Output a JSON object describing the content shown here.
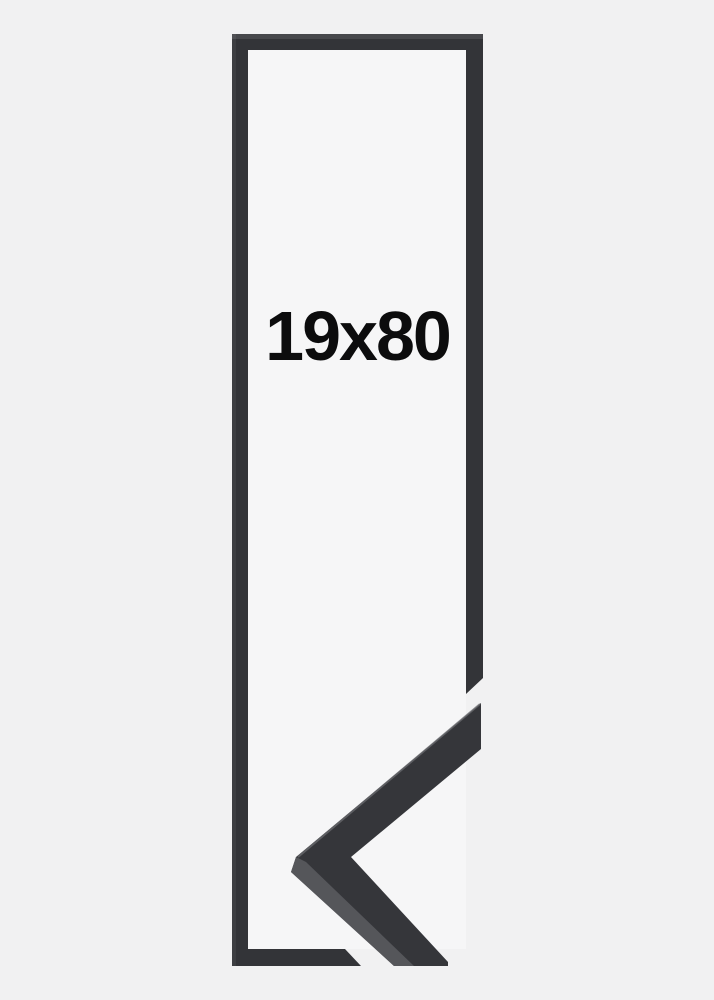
{
  "product": {
    "size_label": "19x80"
  },
  "image": {
    "description": "black picture frame, portrait orientation, with mitered corner profile sample overlapping bottom right"
  },
  "colors": {
    "background": "#f1f1f2",
    "frame_interior": "#f6f6f7",
    "frame_dark": "#333438",
    "sample_face": "#35363a",
    "sample_side_light": "#595a5e",
    "sample_edge_highlight": "#6b6c70",
    "label_text": "#0c0c0d"
  }
}
